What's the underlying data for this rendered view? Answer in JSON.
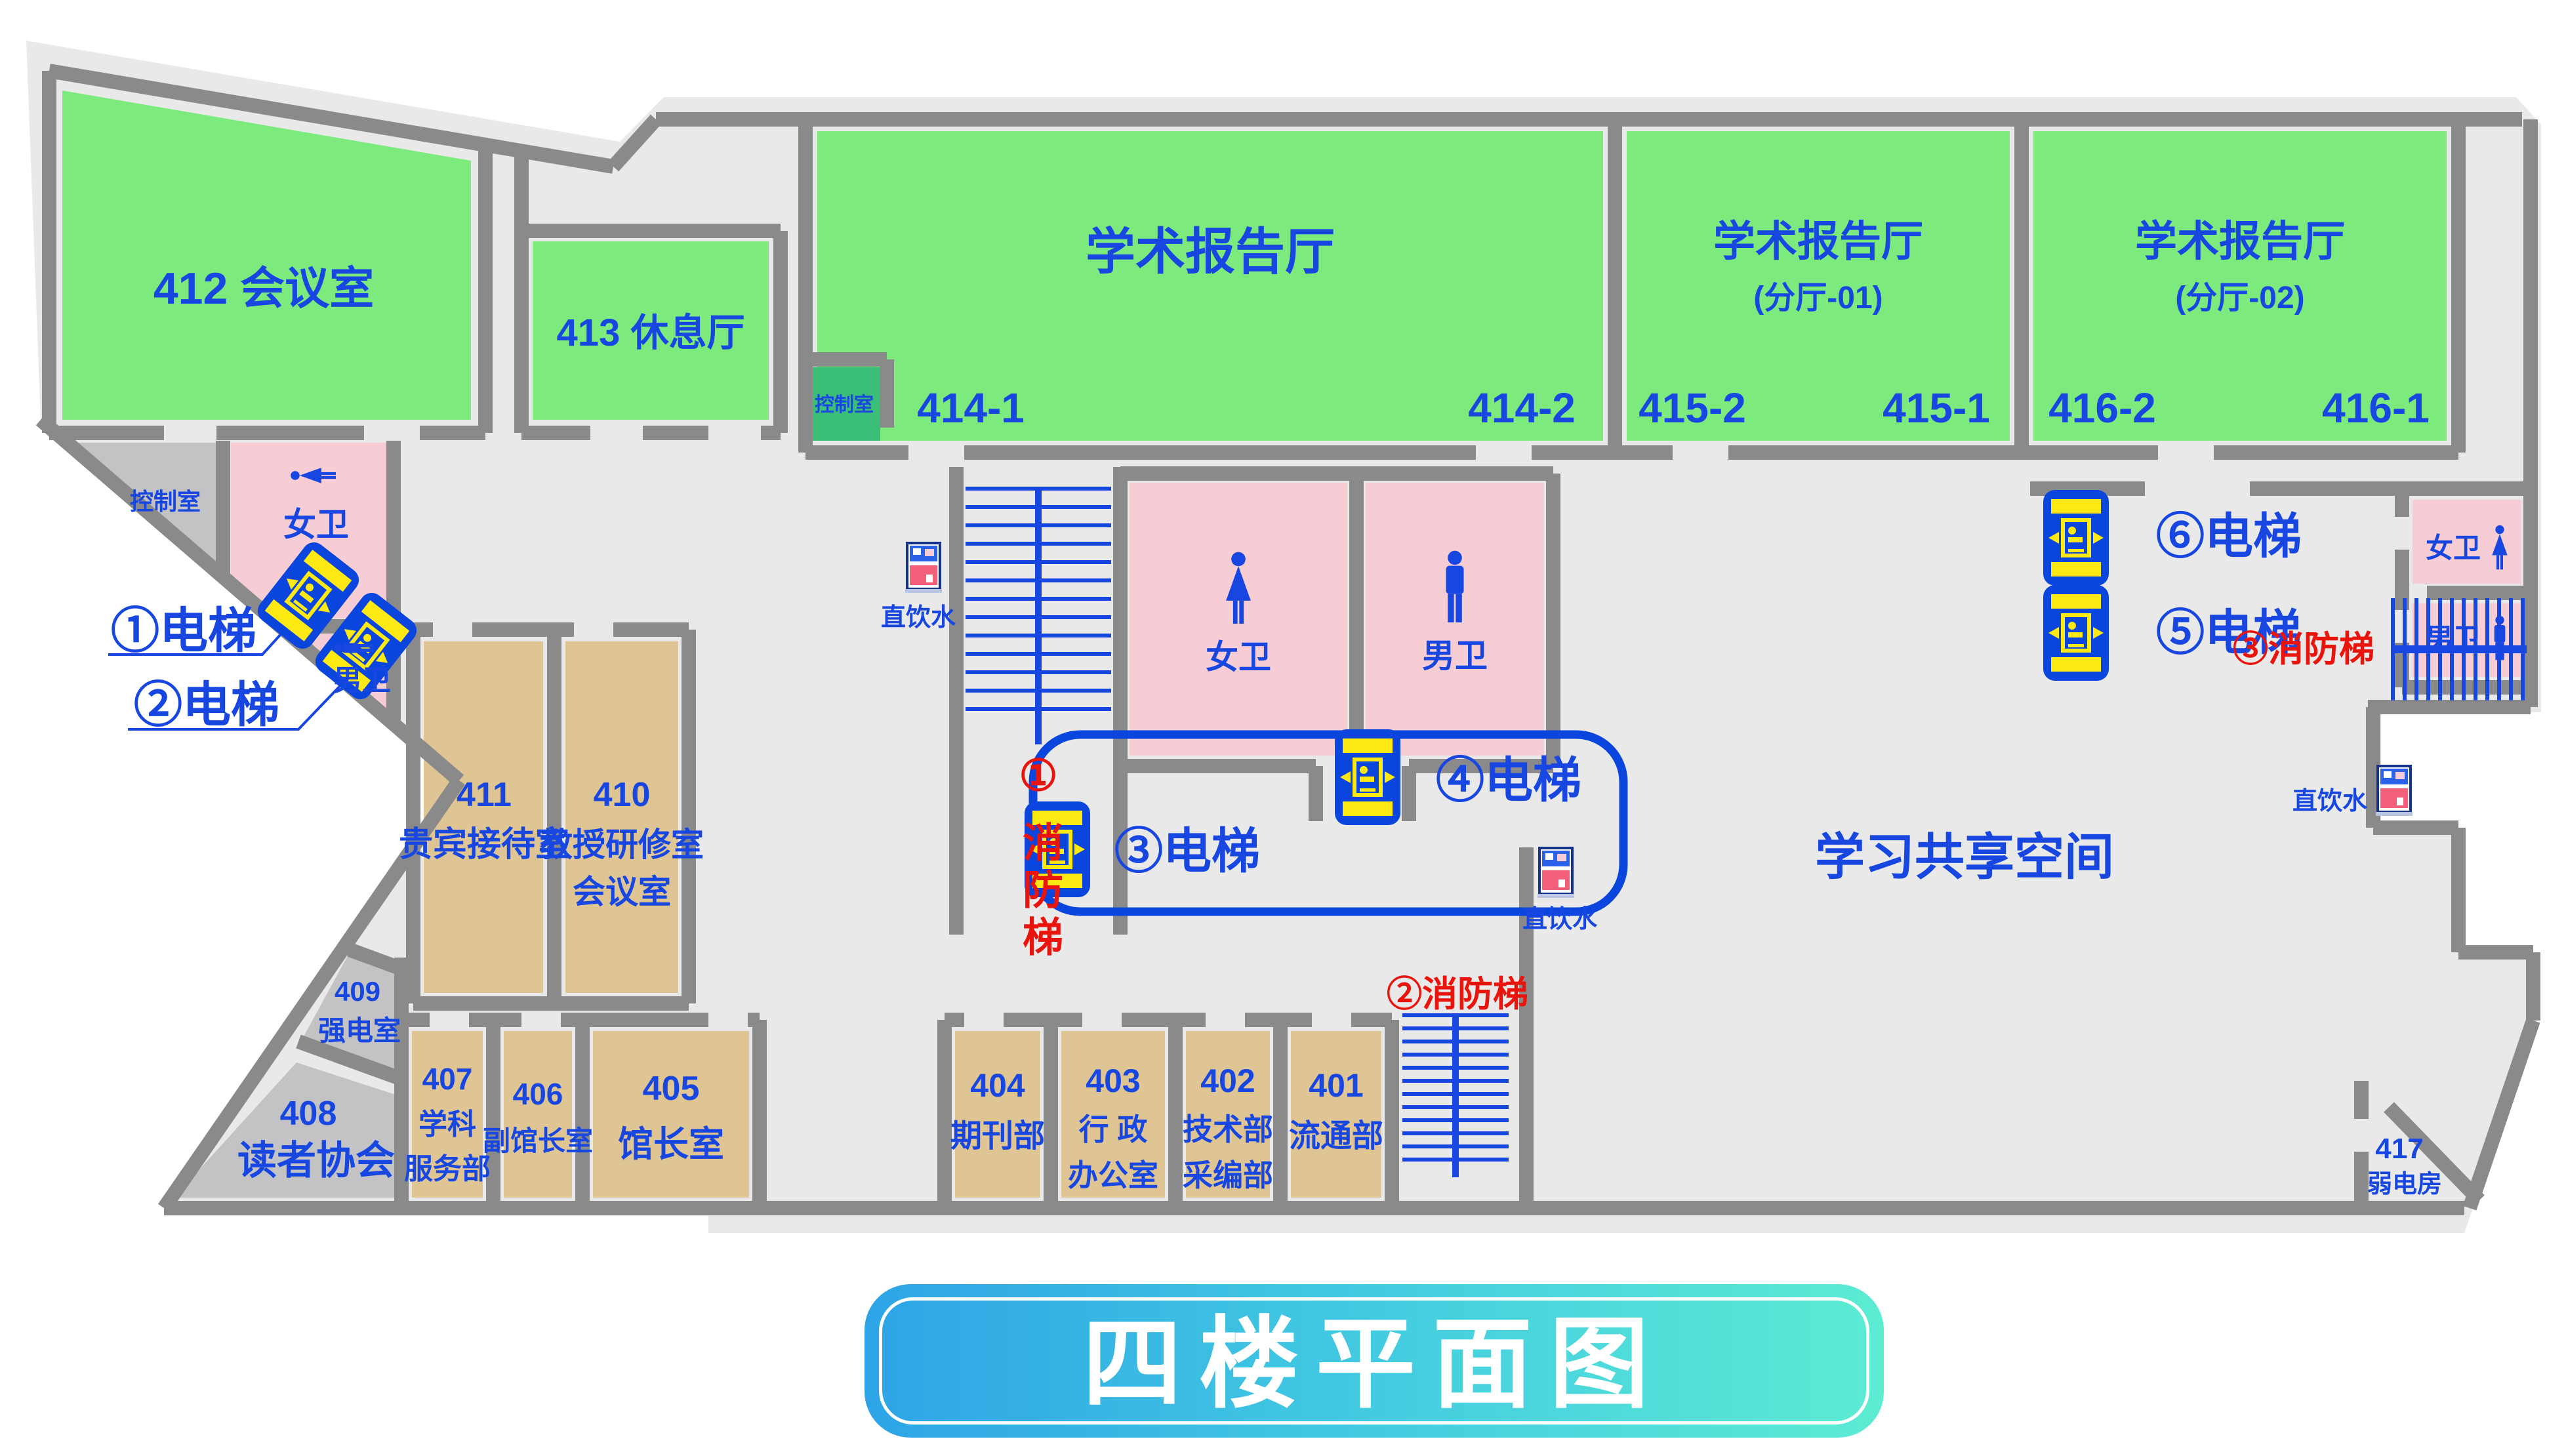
{
  "title": "四楼平面图",
  "rooms": {
    "r412": {
      "label": "412 会议室"
    },
    "r413": {
      "label": "413 休息厅"
    },
    "hall414": {
      "name": "学术报告厅",
      "corner_left": "414-1",
      "corner_right": "414-2"
    },
    "hall415": {
      "name": "学术报告厅",
      "sub": "(分厅-01)",
      "corner_left": "415-2",
      "corner_right": "415-1"
    },
    "hall416": {
      "name": "学术报告厅",
      "sub": "(分厅-02)",
      "corner_left": "416-2",
      "corner_right": "416-1"
    },
    "control_small": "控制室",
    "control_left": "控制室",
    "r411": {
      "number": "411",
      "name": "贵宾接待室"
    },
    "r410": {
      "number": "410",
      "name1": "教授研修室",
      "name2": "会议室"
    },
    "r409": {
      "number": "409",
      "name": "强电室"
    },
    "r408": {
      "number": "408",
      "name": "读者协会"
    },
    "r407": {
      "number": "407",
      "name1": "学科",
      "name2": "服务部"
    },
    "r406": {
      "number": "406",
      "name": "副馆长室"
    },
    "r405": {
      "number": "405",
      "name": "馆长室"
    },
    "r404": {
      "number": "404",
      "name": "期刊部"
    },
    "r403": {
      "number": "403",
      "name1": "行 政",
      "name2": "办公室"
    },
    "r402": {
      "number": "402",
      "name1": "技术部",
      "name2": "采编部"
    },
    "r401": {
      "number": "401",
      "name": "流通部"
    },
    "r417": {
      "number": "417",
      "name": "弱电房"
    },
    "commons": "学习共享空间"
  },
  "toilets": {
    "female": "女卫",
    "male": "男卫"
  },
  "elevators": {
    "e1": "①电梯",
    "e2": "②电梯",
    "e3": "③电梯",
    "e4": "④电梯",
    "e5": "⑤电梯",
    "e6": "⑥电梯"
  },
  "fire_stairs": {
    "f1_num": "①",
    "f1_name": "消防梯",
    "f2": "②消防梯",
    "f3": "③消防梯"
  },
  "water": "直饮水",
  "colors": {
    "floor": "#e9e9ea",
    "wall": "#8a8a8a",
    "room_green": "#7dea7d",
    "control_green": "#3bbf77",
    "toilet_pink": "#f6cdd5",
    "office_tan": "#dfc593",
    "utility_gray": "#c3c3c5",
    "text_blue": "#1747e0",
    "alert_red": "#e9150d",
    "elevator_blue": "#0a46dd",
    "elevator_yellow": "#ffe912",
    "title_grad_left": "#2da4e6",
    "title_grad_right": "#5cecd2"
  }
}
